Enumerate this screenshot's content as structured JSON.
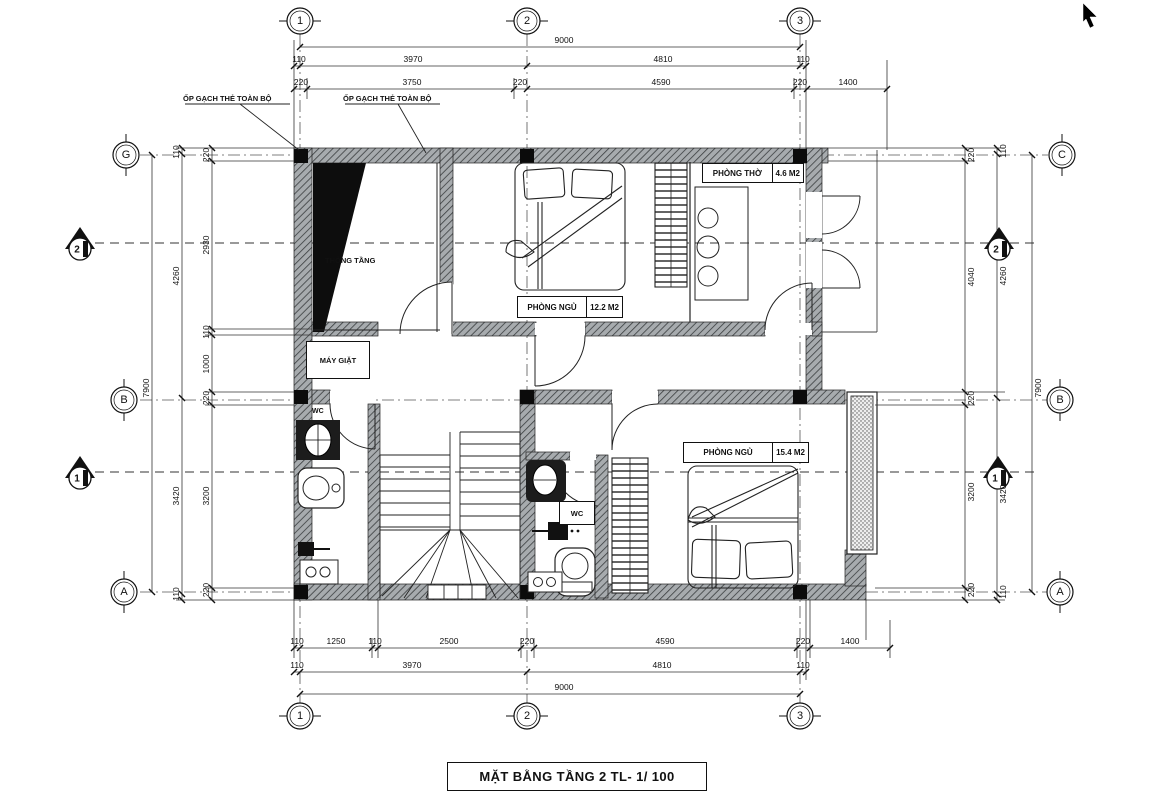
{
  "title": "MẶT BẰNG TẦNG 2 TL- 1/ 100",
  "notes": {
    "note1": "ỐP GẠCH THẺ TOÀN BỘ",
    "note2": "ỐP GẠCH THẺ TOÀN BỘ"
  },
  "grid_bubbles": {
    "top": [
      "1",
      "2",
      "3"
    ],
    "bottom": [
      "1",
      "2",
      "3"
    ],
    "left": [
      "G",
      "B",
      "A"
    ],
    "right": [
      "C",
      "B",
      "A"
    ]
  },
  "section_markers": {
    "left_top": "2",
    "left_bottom": "1",
    "right_top": "2",
    "right_bottom": "1"
  },
  "rooms": {
    "bedroom1_name": "PHÒNG NGỦ",
    "bedroom1_area": "12.2 M2",
    "altar_name": "PHÒNG THỜ",
    "altar_area": "4.6 M2",
    "bedroom2_name": "PHÒNG NGỦ",
    "bedroom2_area": "15.4 M2",
    "void_label": "THÔNG TẦNG",
    "laundry_label": "MÁY GIẶT",
    "wc1_label": "WC",
    "wc2_label": "WC"
  },
  "dims": {
    "top": {
      "total": "9000",
      "row2": [
        "110",
        "3970",
        "4810",
        "110"
      ],
      "row3": [
        "220",
        "3750",
        "220",
        "4590",
        "220",
        "1400"
      ]
    },
    "bottom": {
      "row1": [
        "110",
        "1250",
        "110",
        "2500",
        "220",
        "4590",
        "220",
        "1400"
      ],
      "row2": [
        "110",
        "3970",
        "4810",
        "110"
      ],
      "total": "9000"
    },
    "left": {
      "outer": "7900",
      "mid": [
        "110",
        "4260",
        "3420",
        "110"
      ],
      "inner": [
        "220",
        "2930",
        "110",
        "1000",
        "220",
        "3200",
        "220"
      ]
    },
    "right": {
      "outer": "7900",
      "mid": [
        "110",
        "4260",
        "3420",
        "110"
      ],
      "inner": [
        "220",
        "4040",
        "220",
        "3200",
        "220"
      ]
    }
  },
  "colors": {
    "ink": "#1a1a1a",
    "wall": "#a7abae",
    "paper": "#ffffff"
  }
}
